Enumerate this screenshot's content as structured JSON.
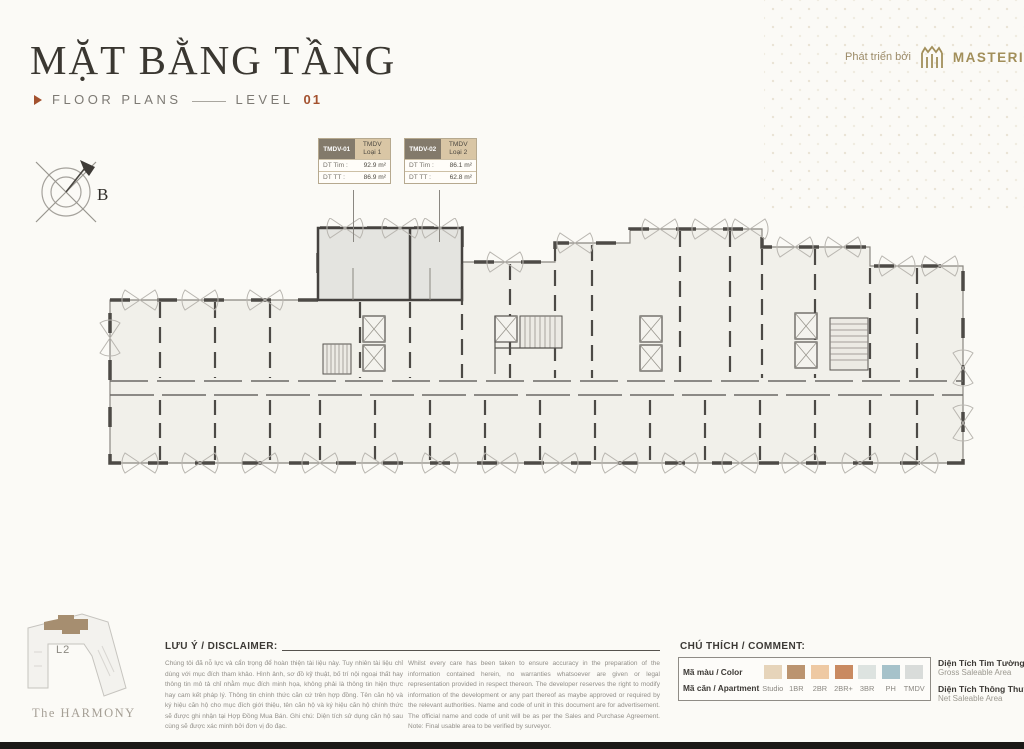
{
  "page": {
    "title": "MẶT BẰNG TẦNG",
    "subtitle": "FLOOR PLANS",
    "level_label": "LEVEL",
    "level_number": "01",
    "developer_prefix": "Phát triển bởi",
    "developer_name": "MASTERISE HOMES",
    "project_name": "The HARMONY",
    "accent_color": "#a3512e",
    "gold_color": "#a28f5a"
  },
  "compass": {
    "north_label": "B"
  },
  "keymap": {
    "level_label": "L2"
  },
  "units": [
    {
      "code": "TMDV-01",
      "type_line1": "TMDV",
      "type_line2": "Loại 1",
      "gross_label": "DT Tim :",
      "gross_value": "92.9 m²",
      "net_label": "DT TT :",
      "net_value": "86.9 m²"
    },
    {
      "code": "TMDV-02",
      "type_line1": "TMDV",
      "type_line2": "Loại 2",
      "gross_label": "DT Tim :",
      "gross_value": "86.1 m²",
      "net_label": "DT TT :",
      "net_value": "62.8 m²"
    }
  ],
  "disclaimer": {
    "heading": "LƯU Ý / DISCLAIMER:",
    "vi": "Chúng tôi đã nỗ lực và cẩn trọng để hoàn thiện tài liệu này. Tuy nhiên tài liệu chỉ dùng với mục đích tham khảo. Hình ảnh, sơ đồ kỹ thuật, bố trí nội ngoại thất hay thông tin mô tả chỉ nhằm mục đích minh họa, không phải là thông tin hiện thực hay cam kết pháp lý. Thông tin chính thức căn cứ trên hợp đồng. Tên căn hộ và ký hiệu căn hộ cho mục đích giới thiệu, tên căn hộ và ký hiệu căn hộ chính thức sẽ được ghi nhận tại Hợp Đồng Mua Bán. Ghi chú: Diện tích sử dụng căn hộ sau cùng sẽ được xác minh bởi đơn vị đo đạc.",
    "en": "Whilst every care has been taken to ensure accuracy in the preparation of the information contained herein, no warranties whatsoever are given or legal representation provided in respect thereon. The developer reserves the right to modify information of the development or any part thereof as maybe approved or required by the relevant authorities. Name and code of unit in this document are for advertisement. The official name and code of unit will be as per the Sales and Purchase Agreement. Note: Final usable area to be verified by surveyor."
  },
  "legend": {
    "heading": "CHÚ THÍCH / COMMENT:",
    "row1_label": "Mã màu / Color",
    "row2_label": "Mã căn / Apartment",
    "items": [
      {
        "label": "Studio",
        "color": "#e6d4ba"
      },
      {
        "label": "1BR",
        "color": "#bb9470"
      },
      {
        "label": "2BR",
        "color": "#eec9a3"
      },
      {
        "label": "2BR+",
        "color": "#c98a61"
      },
      {
        "label": "3BR",
        "color": "#dde3e0"
      },
      {
        "label": "PH",
        "color": "#a6c2ca"
      },
      {
        "label": "TMDV",
        "color": "#d9dcda"
      }
    ],
    "notes": [
      {
        "vi": "Diện Tích Tim Tường - DT Tim",
        "en": "Gross Saleable Area"
      },
      {
        "vi": "Diện Tích Thông Thuỷ - DT TT",
        "en": "Net Saleable Area"
      }
    ]
  }
}
